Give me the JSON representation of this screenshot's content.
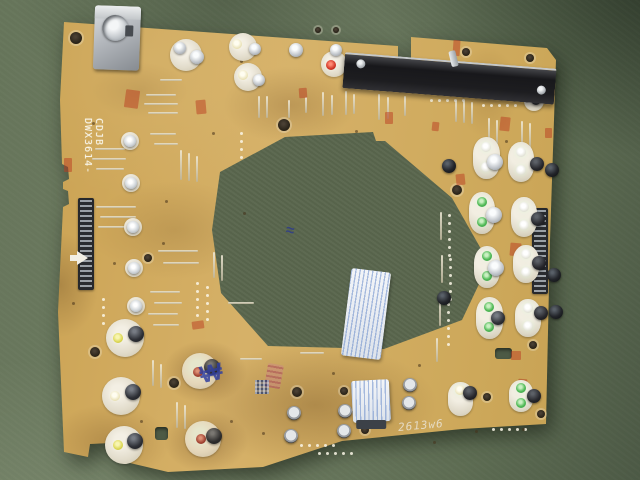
{
  "scene": {
    "description": "Photograph of a bare tan electronics control PCB lying slightly tilted on a dark olive-green leather work mat, large hexagonal cutout in the middle",
    "board_silkscreen": {
      "part_number": "DWX3614-",
      "part_code": "CDJB"
    },
    "handwriting": {
      "pencil_mark": "2613w6",
      "blue_ink_mark": "₩",
      "cutout_blue_mark": "≈"
    },
    "palette": {
      "mat_green": "#66755a",
      "mat_dark_green": "#46523e",
      "board_tan": "#cfa958",
      "stain_brown": "#7b5a2e",
      "silkscreen_white": "#f4f0e2",
      "fader_black": "#1a1a1d",
      "led_green": "#46b34f",
      "led_red": "#cc3327",
      "led_yellow": "#ded84e",
      "module_white": "#eae5d8",
      "metal_silver": "#c9cdd1",
      "stamp_red": "#b53a22",
      "ink_blue": "#3a46a8"
    }
  },
  "components": {
    "round_pots": [
      {
        "x": 186,
        "y": 55,
        "r": 16,
        "led": null,
        "stud": [
          -6,
          -7,
          6,
          "silver"
        ]
      },
      {
        "x": 197,
        "y": 57,
        "r": 8,
        "bare": true,
        "led": null,
        "stud": [
          0,
          0,
          7,
          "silver"
        ]
      },
      {
        "x": 243,
        "y": 47,
        "r": 14,
        "led": [
          -6,
          -3,
          "paleyellow"
        ],
        "stud": [
          12,
          2,
          6,
          "silver"
        ]
      },
      {
        "x": 248,
        "y": 77,
        "r": 14,
        "led": [
          -5,
          -2,
          "paleyellow"
        ],
        "stud": [
          11,
          3,
          6,
          "silver"
        ]
      },
      {
        "x": 334,
        "y": 64,
        "r": 13,
        "led": [
          -3,
          1,
          "red"
        ],
        "stud": [
          2,
          -14,
          6,
          "silver"
        ]
      },
      {
        "x": 296,
        "y": 50,
        "r": 8,
        "bare": true,
        "led": null,
        "stud": [
          0,
          0,
          7,
          "silver"
        ]
      },
      {
        "x": 534,
        "y": 101,
        "r": 10,
        "led": null,
        "stud": [
          2,
          -1,
          5,
          "dark"
        ]
      },
      {
        "x": 130,
        "y": 141,
        "r": 9,
        "led": null,
        "stud": [
          0,
          0,
          6,
          "bright"
        ]
      },
      {
        "x": 131,
        "y": 183,
        "r": 9,
        "led": null,
        "stud": [
          0,
          0,
          6,
          "bright"
        ]
      },
      {
        "x": 133,
        "y": 227,
        "r": 9,
        "led": null,
        "stud": [
          0,
          0,
          6,
          "bright"
        ]
      },
      {
        "x": 134,
        "y": 268,
        "r": 9,
        "led": null,
        "stud": [
          0,
          0,
          6,
          "bright"
        ]
      },
      {
        "x": 136,
        "y": 306,
        "r": 9,
        "led": null,
        "stud": [
          0,
          0,
          6,
          "bright"
        ]
      },
      {
        "x": 125,
        "y": 338,
        "r": 19,
        "led": [
          -7,
          0,
          "yellow"
        ],
        "stud": [
          11,
          -4,
          8,
          "dark"
        ]
      },
      {
        "x": 121,
        "y": 396,
        "r": 19,
        "led": [
          -6,
          0,
          "paleyellow"
        ],
        "stud": [
          12,
          -4,
          8,
          "dark"
        ]
      },
      {
        "x": 124,
        "y": 445,
        "r": 19,
        "led": [
          -6,
          0,
          "yellow"
        ],
        "stud": [
          11,
          -4,
          8,
          "dark"
        ]
      },
      {
        "x": 200,
        "y": 371,
        "r": 18,
        "led": [
          -2,
          1,
          "red"
        ],
        "stud": [
          12,
          -4,
          8,
          "dark"
        ],
        "stain": true
      },
      {
        "x": 203,
        "y": 439,
        "r": 18,
        "led": [
          -2,
          0,
          "red"
        ],
        "stud": [
          11,
          -3,
          8,
          "dark"
        ],
        "stain": true
      }
    ],
    "led_modules": [
      {
        "x": 486,
        "y": 158,
        "w": 27,
        "h": 42,
        "l1": "white",
        "l2": "white",
        "btn": [
          9,
          4,
          "silver"
        ]
      },
      {
        "x": 521,
        "y": 162,
        "w": 26,
        "h": 40,
        "l1": "white",
        "l2": "white",
        "btn": [
          16,
          2,
          "black"
        ]
      },
      {
        "x": 482,
        "y": 213,
        "w": 26,
        "h": 42,
        "l1": "green",
        "l2": "green",
        "btn": [
          12,
          2,
          "silver"
        ]
      },
      {
        "x": 524,
        "y": 217,
        "w": 26,
        "h": 40,
        "l1": "white",
        "l2": "white",
        "btn": [
          14,
          2,
          "black"
        ]
      },
      {
        "x": 487,
        "y": 267,
        "w": 26,
        "h": 42,
        "l1": "green",
        "l2": "green",
        "btn": [
          9,
          1,
          "silver"
        ]
      },
      {
        "x": 526,
        "y": 264,
        "w": 26,
        "h": 38,
        "l1": "white",
        "l2": "white",
        "btn": [
          13,
          -1,
          "black"
        ]
      },
      {
        "x": 489,
        "y": 318,
        "w": 27,
        "h": 42,
        "l1": "green",
        "l2": "green",
        "btn": [
          9,
          0,
          "dark"
        ]
      },
      {
        "x": 528,
        "y": 318,
        "w": 26,
        "h": 38,
        "l1": "white",
        "l2": "white",
        "btn": [
          13,
          -5,
          "black"
        ]
      },
      {
        "x": 460,
        "y": 399,
        "w": 25,
        "h": 34,
        "l1": "paleyellow",
        "l2": null,
        "btn": [
          10,
          -6,
          "black"
        ]
      },
      {
        "x": 521,
        "y": 396,
        "w": 24,
        "h": 32,
        "l1": "green",
        "l2": "green",
        "btn": [
          13,
          0,
          "black"
        ]
      }
    ],
    "capacitors": [
      [
        552,
        170,
        "black"
      ],
      [
        554,
        275,
        "black"
      ],
      [
        556,
        312,
        "black"
      ],
      [
        449,
        166,
        "black"
      ],
      [
        444,
        298,
        "black"
      ],
      [
        294,
        413,
        "silver"
      ],
      [
        291,
        436,
        "silver"
      ],
      [
        345,
        411,
        "silver"
      ],
      [
        344,
        431,
        "silver"
      ],
      [
        410,
        385,
        "silver"
      ],
      [
        409,
        403,
        "silver"
      ]
    ],
    "ffc_connectors": [
      [
        78,
        198,
        16,
        92
      ],
      [
        532,
        208,
        16,
        86
      ]
    ],
    "jumpers": [
      [
        258,
        96,
        22,
        "v"
      ],
      [
        266,
        96,
        22,
        "v"
      ],
      [
        288,
        100,
        18,
        "v"
      ],
      [
        305,
        97,
        16,
        "v"
      ],
      [
        322,
        92,
        24,
        "v"
      ],
      [
        331,
        95,
        20,
        "v"
      ],
      [
        345,
        91,
        24,
        "v"
      ],
      [
        353,
        94,
        20,
        "v"
      ],
      [
        378,
        94,
        26,
        "v"
      ],
      [
        387,
        97,
        22,
        "v"
      ],
      [
        404,
        96,
        20,
        "v"
      ],
      [
        455,
        100,
        22,
        "v"
      ],
      [
        463,
        101,
        22,
        "v"
      ],
      [
        471,
        102,
        22,
        "v"
      ],
      [
        488,
        118,
        26,
        "v"
      ],
      [
        496,
        120,
        24,
        "v"
      ],
      [
        521,
        121,
        28,
        "v"
      ],
      [
        529,
        123,
        26,
        "v"
      ],
      [
        146,
        94,
        30,
        "h"
      ],
      [
        144,
        103,
        34,
        "h"
      ],
      [
        148,
        112,
        30,
        "h"
      ],
      [
        160,
        79,
        22,
        "h"
      ],
      [
        95,
        148,
        30,
        "h"
      ],
      [
        92,
        158,
        34,
        "h"
      ],
      [
        96,
        168,
        28,
        "h"
      ],
      [
        150,
        133,
        26,
        "h"
      ],
      [
        154,
        143,
        24,
        "h"
      ],
      [
        96,
        206,
        40,
        "h"
      ],
      [
        100,
        216,
        36,
        "h"
      ],
      [
        98,
        226,
        32,
        "h"
      ],
      [
        158,
        250,
        40,
        "h"
      ],
      [
        163,
        262,
        36,
        "h"
      ],
      [
        150,
        291,
        30,
        "h"
      ],
      [
        154,
        302,
        28,
        "h"
      ],
      [
        148,
        313,
        30,
        "h"
      ],
      [
        153,
        324,
        26,
        "h"
      ],
      [
        180,
        150,
        30,
        "v"
      ],
      [
        188,
        153,
        28,
        "v"
      ],
      [
        196,
        156,
        26,
        "v"
      ],
      [
        213,
        252,
        26,
        "v"
      ],
      [
        221,
        255,
        26,
        "v"
      ],
      [
        152,
        360,
        26,
        "v"
      ],
      [
        160,
        364,
        24,
        "v"
      ],
      [
        176,
        402,
        26,
        "v"
      ],
      [
        184,
        405,
        24,
        "v"
      ],
      [
        440,
        212,
        28,
        "v"
      ],
      [
        441,
        255,
        28,
        "v"
      ],
      [
        439,
        300,
        26,
        "v"
      ],
      [
        436,
        338,
        24,
        "v"
      ],
      [
        228,
        302,
        26,
        "h"
      ],
      [
        240,
        358,
        22,
        "h"
      ],
      [
        300,
        352,
        24,
        "h"
      ]
    ],
    "pad_rows": [
      [
        196,
        282,
        5,
        "v"
      ],
      [
        206,
        286,
        5,
        "v"
      ],
      [
        448,
        214,
        6,
        "v"
      ],
      [
        449,
        258,
        6,
        "v"
      ],
      [
        447,
        303,
        6,
        "v"
      ],
      [
        300,
        444,
        5,
        "h"
      ],
      [
        318,
        452,
        5,
        "h"
      ],
      [
        430,
        99,
        5,
        "h"
      ],
      [
        482,
        104,
        5,
        "h"
      ],
      [
        102,
        298,
        4,
        "v"
      ],
      [
        240,
        132,
        4,
        "v"
      ],
      [
        492,
        428,
        5,
        "h"
      ]
    ],
    "holes": [
      [
        76,
        38,
        6
      ],
      [
        284,
        125,
        6
      ],
      [
        148,
        258,
        4
      ],
      [
        95,
        352,
        5
      ],
      [
        174,
        383,
        5
      ],
      [
        297,
        392,
        5
      ],
      [
        344,
        391,
        4
      ],
      [
        365,
        430,
        4
      ],
      [
        457,
        190,
        5
      ],
      [
        487,
        397,
        4
      ],
      [
        541,
        414,
        4
      ],
      [
        318,
        30,
        3
      ],
      [
        336,
        30,
        3
      ],
      [
        466,
        52,
        4
      ],
      [
        530,
        58,
        4
      ],
      [
        533,
        345,
        4
      ]
    ],
    "green_cutouts": [
      [
        155,
        427,
        13,
        13
      ],
      [
        495,
        348,
        17,
        11
      ]
    ],
    "red_stamps": [
      [
        125,
        90,
        14,
        18,
        8
      ],
      [
        196,
        100,
        10,
        14,
        -5
      ],
      [
        385,
        112,
        8,
        12,
        0
      ],
      [
        453,
        40,
        7,
        16,
        4
      ],
      [
        500,
        117,
        10,
        14,
        6
      ],
      [
        64,
        158,
        8,
        14,
        0
      ],
      [
        456,
        174,
        9,
        11,
        -6
      ],
      [
        510,
        243,
        11,
        13,
        5
      ],
      [
        192,
        321,
        12,
        8,
        -8
      ],
      [
        511,
        351,
        10,
        9,
        0
      ],
      [
        518,
        379,
        9,
        11,
        4
      ],
      [
        299,
        88,
        8,
        10,
        -4
      ],
      [
        545,
        128,
        7,
        10,
        0
      ],
      [
        432,
        122,
        7,
        9,
        6
      ]
    ],
    "specks": [
      [
        92,
        122
      ],
      [
        212,
        132
      ],
      [
        243,
        212
      ],
      [
        162,
        242
      ],
      [
        332,
        372
      ],
      [
        262,
        432
      ],
      [
        433,
        441
      ],
      [
        522,
        428
      ],
      [
        113,
        262
      ],
      [
        72,
        302
      ],
      [
        418,
        364
      ],
      [
        355,
        130
      ],
      [
        230,
        420
      ],
      [
        140,
        420
      ],
      [
        475,
        430
      ],
      [
        165,
        200
      ],
      [
        505,
        140
      ],
      [
        240,
        60
      ]
    ]
  }
}
